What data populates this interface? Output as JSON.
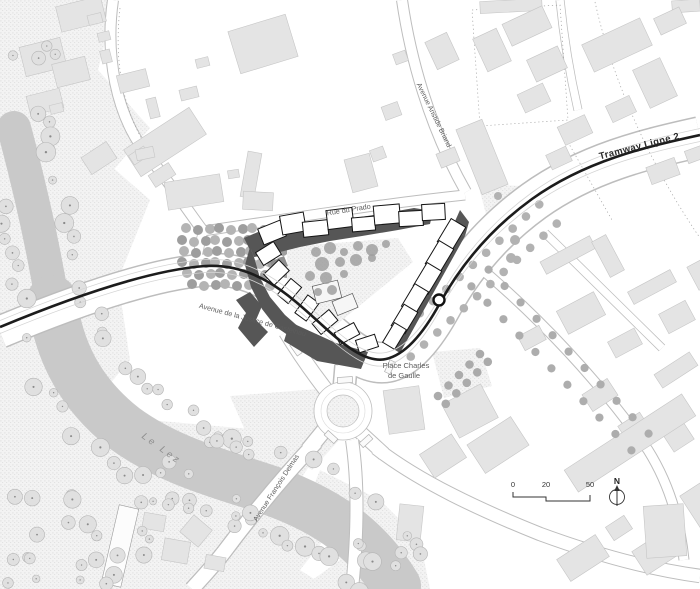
{
  "map": {
    "street_labels": {
      "tramway": "Tramway Ligne 2",
      "rue_du_prado": "Rue du Prado",
      "avenue_aristide_briand": "Avenue Aristide Briand",
      "avenue_justice_castelnau": "Avenue de la Justice de Castelnau",
      "avenue_francois_delmas": "Avenue François Delmas",
      "place_charles_line1": "Place Charles",
      "place_charles_line2": "de Gaulle"
    },
    "river_label": "Le Lez",
    "scale_bar": {
      "ticks": [
        "0",
        "20",
        "50"
      ]
    },
    "compass": {
      "north": "N"
    },
    "colors": {
      "tram_line": "#1c1c1c",
      "project_dark": "#565656",
      "project_mid": "#8e8e8e",
      "river": "#c9c9c9",
      "context_building": "#e4e4e4",
      "stipple_base": "#f3f3f3",
      "road_casing": "#bdbdbd",
      "label": "#5c5c5c"
    }
  }
}
